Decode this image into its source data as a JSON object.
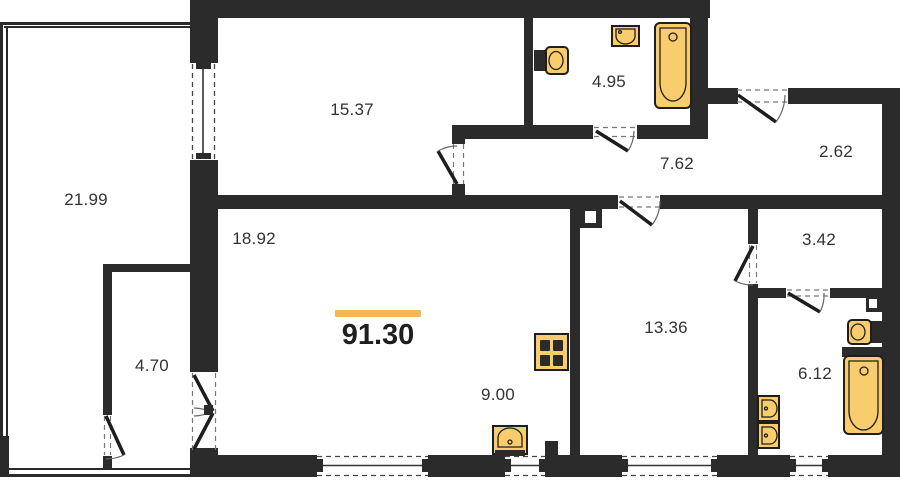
{
  "plan": {
    "total_area": "91.30",
    "rooms": [
      {
        "id": "loggia",
        "area": "21.99"
      },
      {
        "id": "bedroom",
        "area": "15.37"
      },
      {
        "id": "bathroom-small",
        "area": "4.95"
      },
      {
        "id": "hallway",
        "area": "7.62"
      },
      {
        "id": "entry-hall",
        "area": "2.62"
      },
      {
        "id": "living-room",
        "area": "18.92"
      },
      {
        "id": "wardrobe",
        "area": "3.42"
      },
      {
        "id": "bedroom-2",
        "area": "13.36"
      },
      {
        "id": "storage",
        "area": "4.70"
      },
      {
        "id": "kitchen",
        "area": "9.00"
      },
      {
        "id": "bathroom-large",
        "area": "6.12"
      }
    ],
    "fixtures": [
      "toilet-icon",
      "wash-sink-icon",
      "bathtub-icon",
      "stove-icon",
      "kitchen-sink-icon",
      "toilet-2-icon",
      "bathtub-2-icon",
      "basin-icon",
      "basin-2-icon"
    ],
    "colors": {
      "wall": "#2b2b2b",
      "accent": "#f0ba55",
      "fixture_fill": "#f9cd6d",
      "text": "#333333"
    }
  }
}
